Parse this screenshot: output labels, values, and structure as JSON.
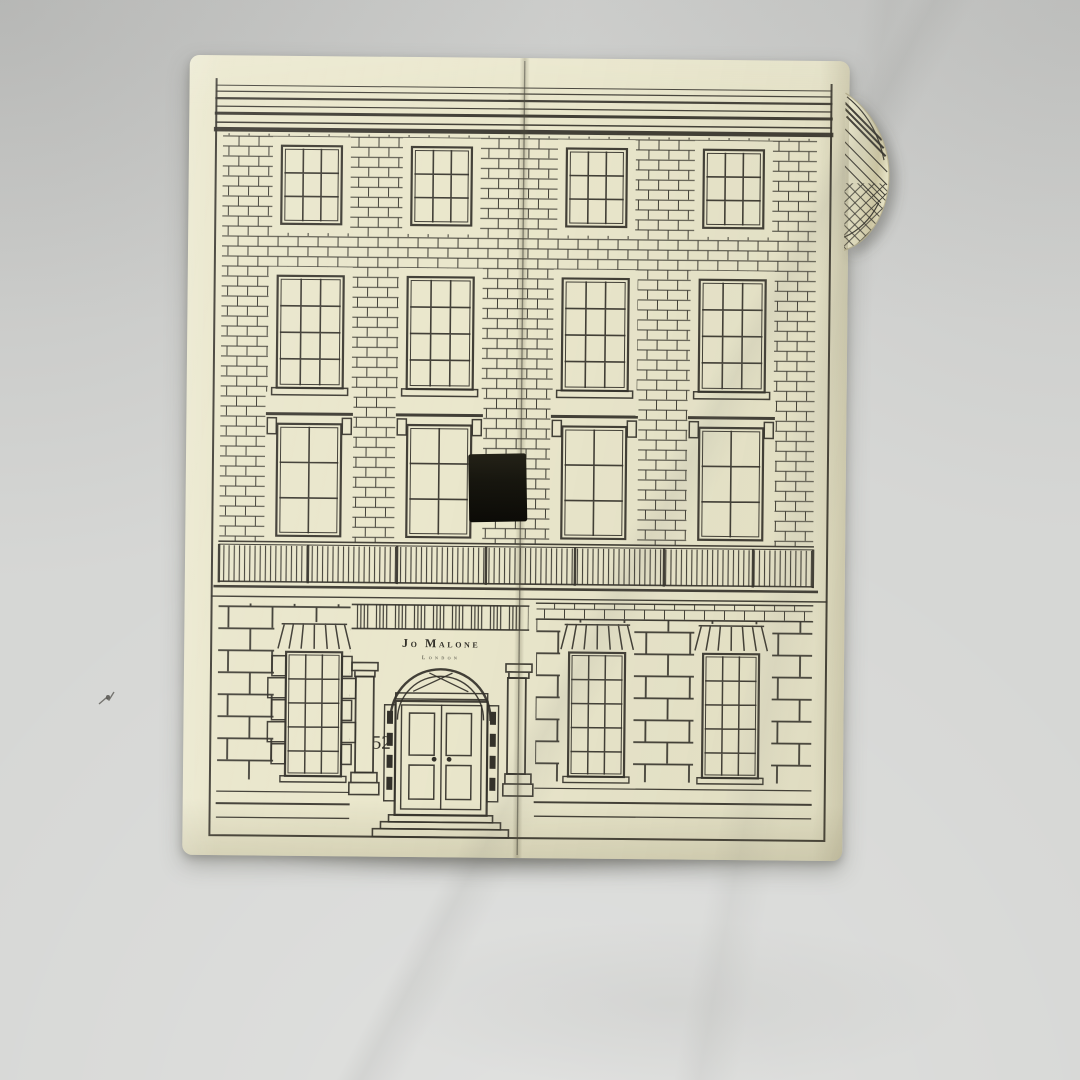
{
  "scene": {
    "description": "Cream Jo Malone London advent-calendar gift box printed as an engraved Georgian townhouse facade, standing upright on a light grey studio backdrop. The box opens at a centre seam with a black ribbon pull tab; the paper wrap is peeling at the top-right corner.",
    "colors": {
      "backdrop": "#d6d7d5",
      "box": "#eae7cc",
      "ink": "#33312a",
      "tab": "#17160f",
      "flapshade": "#cfc8a4"
    }
  },
  "artwork": {
    "shop_sign": {
      "brand": "Jo Malone",
      "subtitle": "London"
    },
    "house_number": "52"
  }
}
